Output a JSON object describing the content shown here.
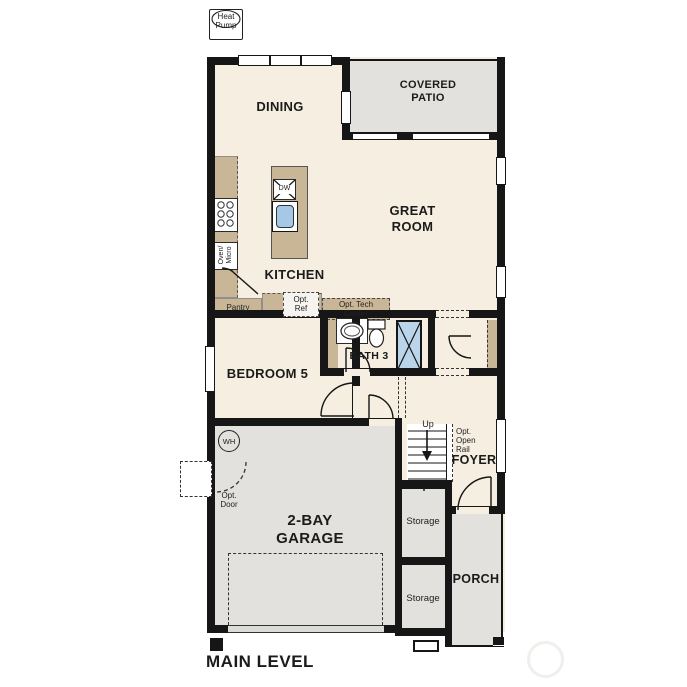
{
  "labels": {
    "heat_pump": "Heat\nPump",
    "dining": "DINING",
    "covered_patio": "COVERED\nPATIO",
    "great_room": "GREAT\nROOM",
    "kitchen": "KITCHEN",
    "dw": "DW",
    "oven_micro": "Oven/\nMicro",
    "pantry": "Pantry",
    "opt_ref": "Opt.\nRef",
    "opt_tech_center": "Opt. Tech\nCenter",
    "bath3": "BATH 3",
    "bedroom5": "BEDROOM 5",
    "wh": "WH",
    "opt_door": "Opt.\nDoor",
    "garage": "2-BAY\nGARAGE",
    "up": "Up",
    "opt_open_rail": "Opt.\nOpen\nRail",
    "foyer": "FOYER",
    "storage_1": "Storage",
    "storage_2": "Storage",
    "porch": "PORCH",
    "main_level": "MAIN LEVEL"
  },
  "colors": {
    "room_fill": "#f6eee1",
    "outdoor_fill": "#e2e1dd",
    "counter_fill": "#c9b697",
    "shower_fill": "#bad4ea",
    "sink_fill": "#a5c8e6",
    "wall": "#161616"
  }
}
